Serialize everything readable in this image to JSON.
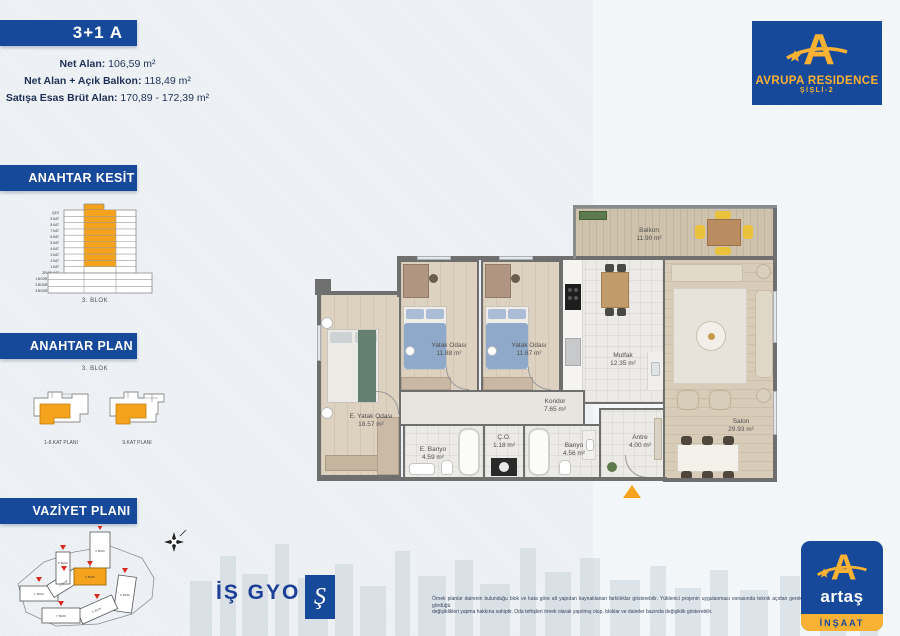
{
  "header": {
    "unit_type": "3+1 A"
  },
  "stats": [
    {
      "label": "Net Alan:",
      "value": " 106,59 m²"
    },
    {
      "label": "Net Alan + Açık Balkon:",
      "value": " 118,49 m²"
    },
    {
      "label": "Satışa Esas Brüt Alan:",
      "value": " 170,89 - 172,39 m²"
    }
  ],
  "sidebar": {
    "kesit_title": "ANAHTAR KESİT",
    "kesit_caption": "3. BLOK",
    "kesit_floors": [
      "ÇATI",
      "9.KAT",
      "8.KAT",
      "7.KAT",
      "6.KAT",
      "5.KAT",
      "4.KAT",
      "3.KAT",
      "2.KAT",
      "1.KAT",
      "ZEMİN KAT",
      "1.BODRUM KAT",
      "2.BODRUM KAT",
      "3.BODRUM KAT"
    ],
    "plan_title": "ANAHTAR PLAN",
    "plan_caption": "3. BLOK",
    "plan_left_label": "1-8.KAT PLANI",
    "plan_right_label": "9.KAT PLANI",
    "vaziyet_title": "VAZİYET PLANI",
    "site_blocks": [
      "1. BLOK",
      "2. BLOK",
      "3. BLOK",
      "4. BLOK",
      "5. BLOK",
      "6. BLOK",
      "7. BLOK",
      "8. BLOK"
    ]
  },
  "floorplan": {
    "rooms": [
      {
        "name": "Balkon",
        "area": "11.90 m²"
      },
      {
        "name": "Yatak Odası",
        "area": "11.88 m²"
      },
      {
        "name": "Yatak Odası",
        "area": "11.87 m²"
      },
      {
        "name": "Mutfak",
        "area": "12.35 m²"
      },
      {
        "name": "Salon",
        "area": "29.93 m²"
      },
      {
        "name": "E. Yatak Odası",
        "area": "18.57 m²"
      },
      {
        "name": "Koridor",
        "area": "7.65 m²"
      },
      {
        "name": "E. Banyo",
        "area": "4.59 m²"
      },
      {
        "name": "Ç.O.",
        "area": "1.18 m²"
      },
      {
        "name": "Banyo",
        "area": "4.56 m²"
      },
      {
        "name": "Antre",
        "area": "4.00 m²"
      }
    ]
  },
  "brand": {
    "residence_name": "AVRUPA RESIDENCE",
    "residence_sub": "ŞİŞLİ-2",
    "logo_letter": "A",
    "isgyo_label": "İŞ GYO",
    "isbank_glyph": "Ş",
    "artas_name": "artaş",
    "artas_sub": "İNŞAAT"
  },
  "footer": {
    "disclaimer_line1": "Örnek planlar dairenin bulunduğu blok ve kata göre alt yapıdan kaynaklanan farklılıklar gösterebilir. Yüklenici projenin uygulanması esnasında teknik açıdan gerekli gördüğü",
    "disclaimer_line2": "değişiklikleri yapma hakkına sahiptir. Oda tefrişleri örnek olarak yapılmış olup, bloklar ve daireler bazında değişiklik gösterebilir."
  },
  "colors": {
    "brand_blue": "#17499B",
    "accent_orange": "#F5A31C",
    "logo_yellow": "#F9B233"
  }
}
